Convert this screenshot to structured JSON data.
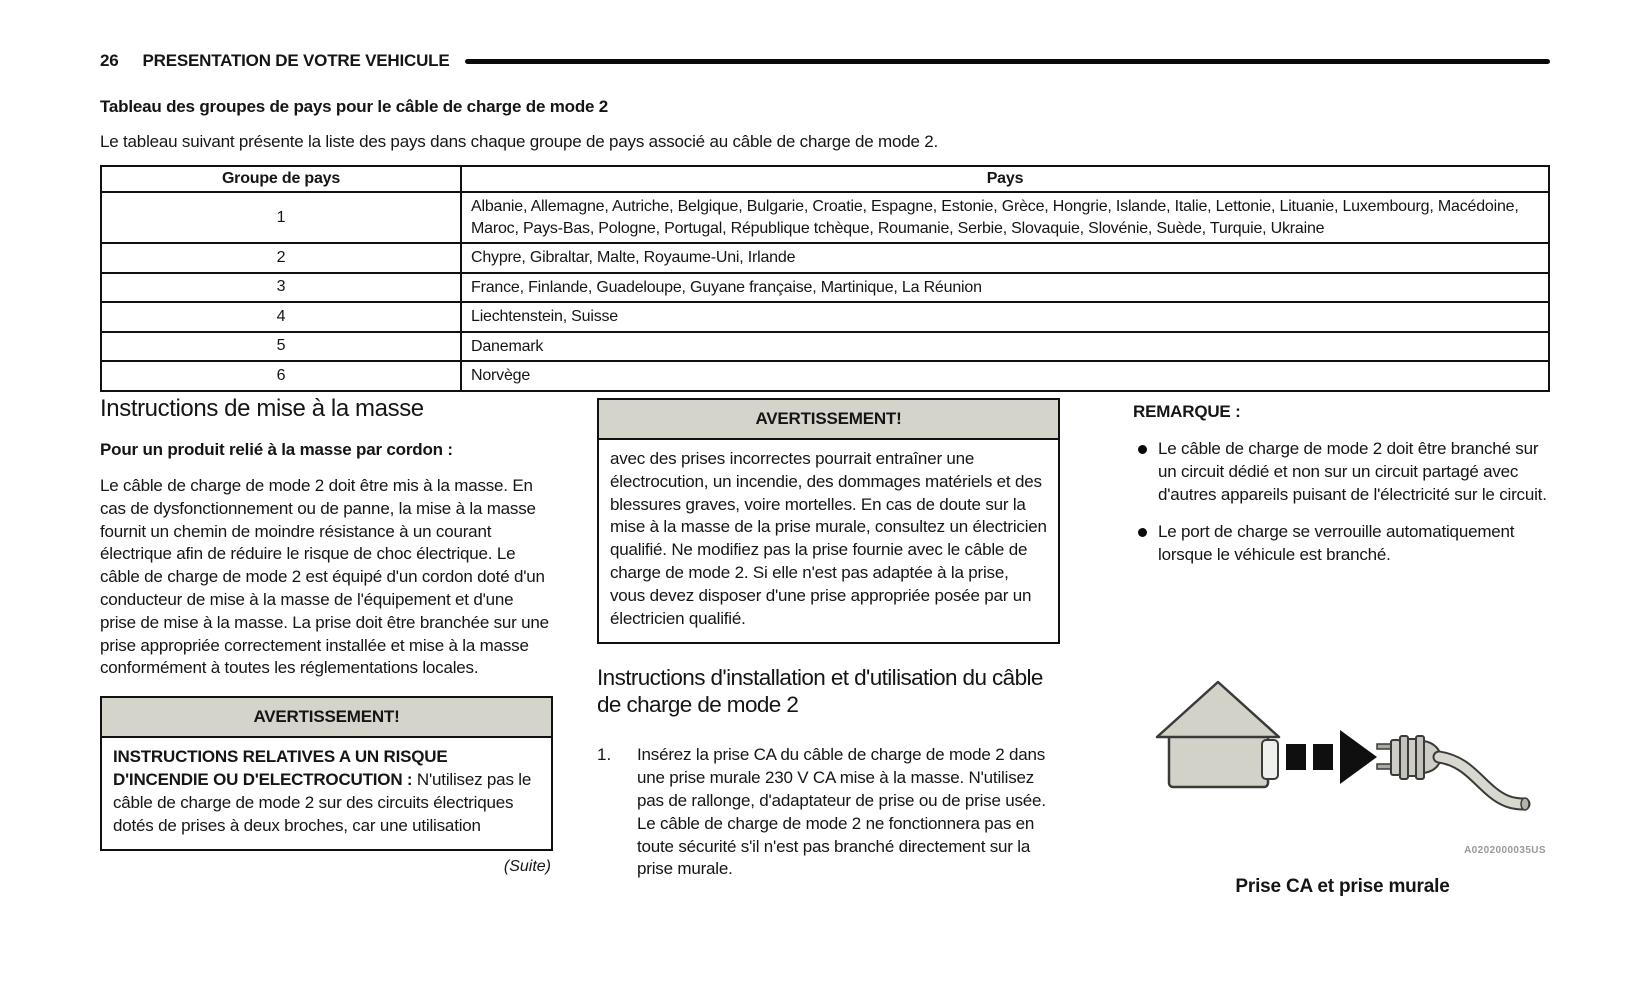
{
  "header": {
    "page_number": "26",
    "chapter": "PRESENTATION DE VOTRE VEHICULE"
  },
  "country_table": {
    "title": "Tableau des groupes de pays pour le câble de charge de mode 2",
    "intro": "Le tableau suivant présente la liste des pays dans chaque groupe de pays associé au câble de charge de mode 2.",
    "headers": [
      "Groupe de pays",
      "Pays"
    ],
    "rows": [
      {
        "group": "1",
        "countries": "Albanie, Allemagne, Autriche, Belgique, Bulgarie, Croatie, Espagne, Estonie, Grèce, Hongrie, Islande, Italie, Lettonie, Lituanie, Luxembourg, Macédoine, Maroc, Pays-Bas, Pologne, Portugal, République tchèque, Roumanie, Serbie, Slovaquie, Slovénie, Suède, Turquie, Ukraine"
      },
      {
        "group": "2",
        "countries": "Chypre, Gibraltar, Malte, Royaume-Uni, Irlande"
      },
      {
        "group": "3",
        "countries": "France, Finlande, Guadeloupe, Guyane française, Martinique, La Réunion"
      },
      {
        "group": "4",
        "countries": "Liechtenstein, Suisse"
      },
      {
        "group": "5",
        "countries": "Danemark"
      },
      {
        "group": "6",
        "countries": "Norvège"
      }
    ]
  },
  "grounding": {
    "heading": "Instructions de mise à la masse",
    "subheading": "Pour un produit relié à la masse par cordon :",
    "body": "Le câble de charge de mode 2 doit être mis à la masse. En cas de dysfonctionnement ou de panne, la mise à la masse fournit un chemin de moindre résistance à un courant électrique afin de réduire le risque de choc électrique. Le câble de charge de mode 2 est équipé d'un cordon doté d'un conducteur de mise à la masse de l'équipement et d'une prise de mise à la masse. La prise doit être branchée sur une prise appropriée correctement installée et mise à la masse conformément à toutes les réglementations locales.",
    "warning": {
      "title": "AVERTISSEMENT!",
      "lead": "INSTRUCTIONS RELATIVES A UN RISQUE D'INCENDIE OU D'ELECTROCUTION :",
      "body": "N'utilisez pas le câble de charge de mode 2 sur des circuits électriques dotés de prises à deux broches, car une utilisation"
    },
    "continuation": "(Suite)"
  },
  "warning2": {
    "title": "AVERTISSEMENT!",
    "body": "avec des prises incorrectes pourrait entraîner une électrocution, un incendie, des dommages matériels et des blessures graves, voire mortelles. En cas de doute sur la mise à la masse de la prise murale, consultez un électricien qualifié. Ne modifiez pas la prise fournie avec le câble de charge de mode 2. Si elle n'est pas adaptée à la prise, vous devez disposer d'une prise appropriée posée par un électricien qualifié."
  },
  "installation": {
    "heading": "Instructions d'installation et d'utilisation du câble de charge de mode 2",
    "steps": [
      {
        "num": "1.",
        "text": "Insérez la prise CA du câble de charge de mode 2 dans une prise murale 230 V CA mise à la masse. N'utilisez pas de rallonge, d'adaptateur de prise ou de prise usée. Le câble de charge de mode 2 ne fonctionnera pas en toute sécurité s'il n'est pas branché directement sur la prise murale."
      }
    ]
  },
  "note": {
    "label": "REMARQUE :",
    "bullets": [
      "Le câble de charge de mode 2 doit être branché sur un circuit dédié et non sur un circuit partagé avec d'autres appareils puisant de l'électricité sur le circuit.",
      "Le port de charge se verrouille automatiquement lorsque le véhicule est branché."
    ]
  },
  "figure": {
    "watermark": "A0202000035US",
    "caption": "Prise CA et prise murale"
  },
  "colors": {
    "warning_header_bg": "#d4d4cb",
    "figure_fill_gray": "#d2d2c9",
    "ink": "#151515",
    "watermark_gray": "#99999a"
  }
}
